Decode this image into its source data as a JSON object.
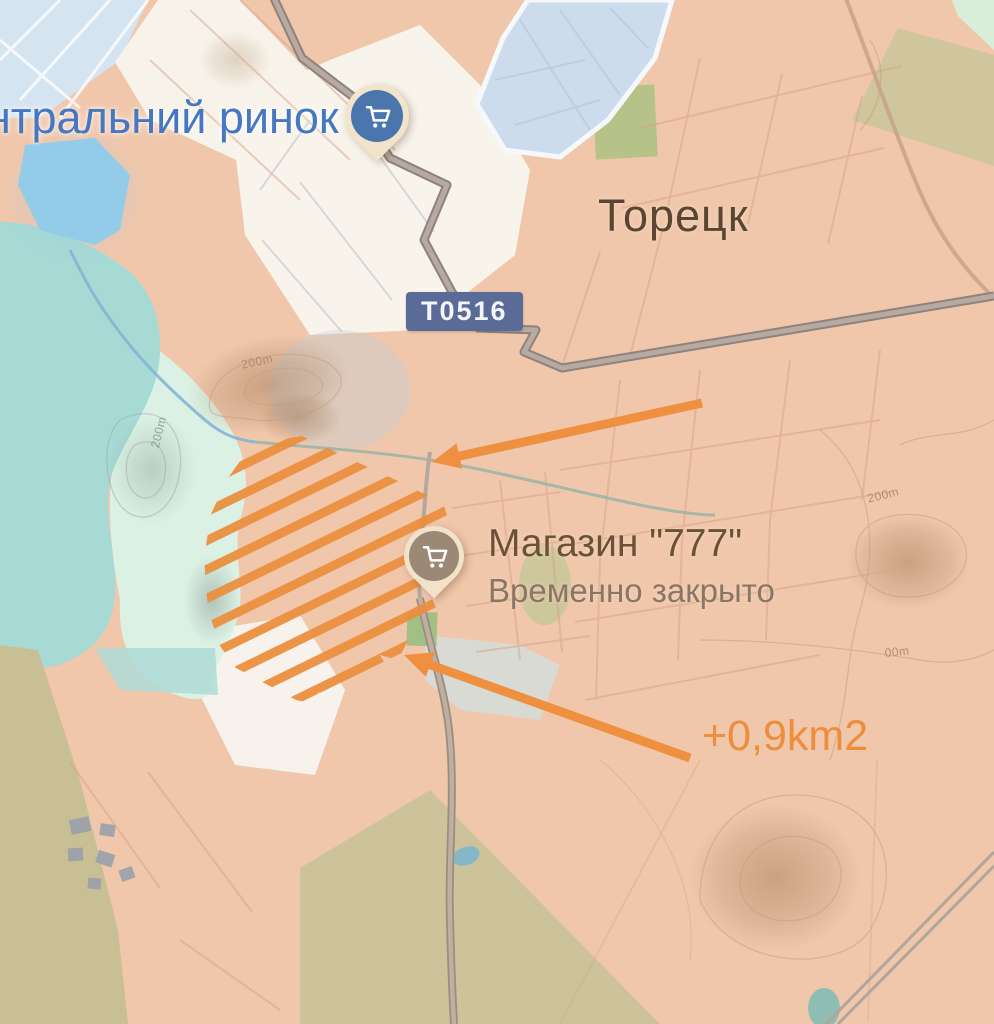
{
  "map": {
    "labels": {
      "market": "нтральний ринок",
      "city": "Торецк",
      "road_badge": "Т0516",
      "store_name": "Магазин \"777\"",
      "store_status": "Временно закрыто",
      "area_gain": "+0,9km2"
    },
    "contour_labels": [
      "200m",
      "200m",
      "200m",
      "00m"
    ],
    "pins": [
      {
        "id": "market-pin",
        "icon": "shopping-cart-icon",
        "circle_color": "#4B76AD"
      },
      {
        "id": "store-pin",
        "icon": "shopping-cart-icon",
        "circle_color": "#968472"
      }
    ],
    "colors": {
      "annotation_orange": "#EE8E3C",
      "market_label_blue": "#4678C2",
      "city_label_brown": "#5A4531",
      "store_label_brown": "#6D5137",
      "status_gray_brown": "#8B7565",
      "badge_background": "#5B6B97",
      "territory_salmon": "#F0C7AB",
      "territory_teal": "#A7D9D5",
      "territory_mint": "#DBF1E4",
      "water_blue": "#93CCE9"
    }
  }
}
